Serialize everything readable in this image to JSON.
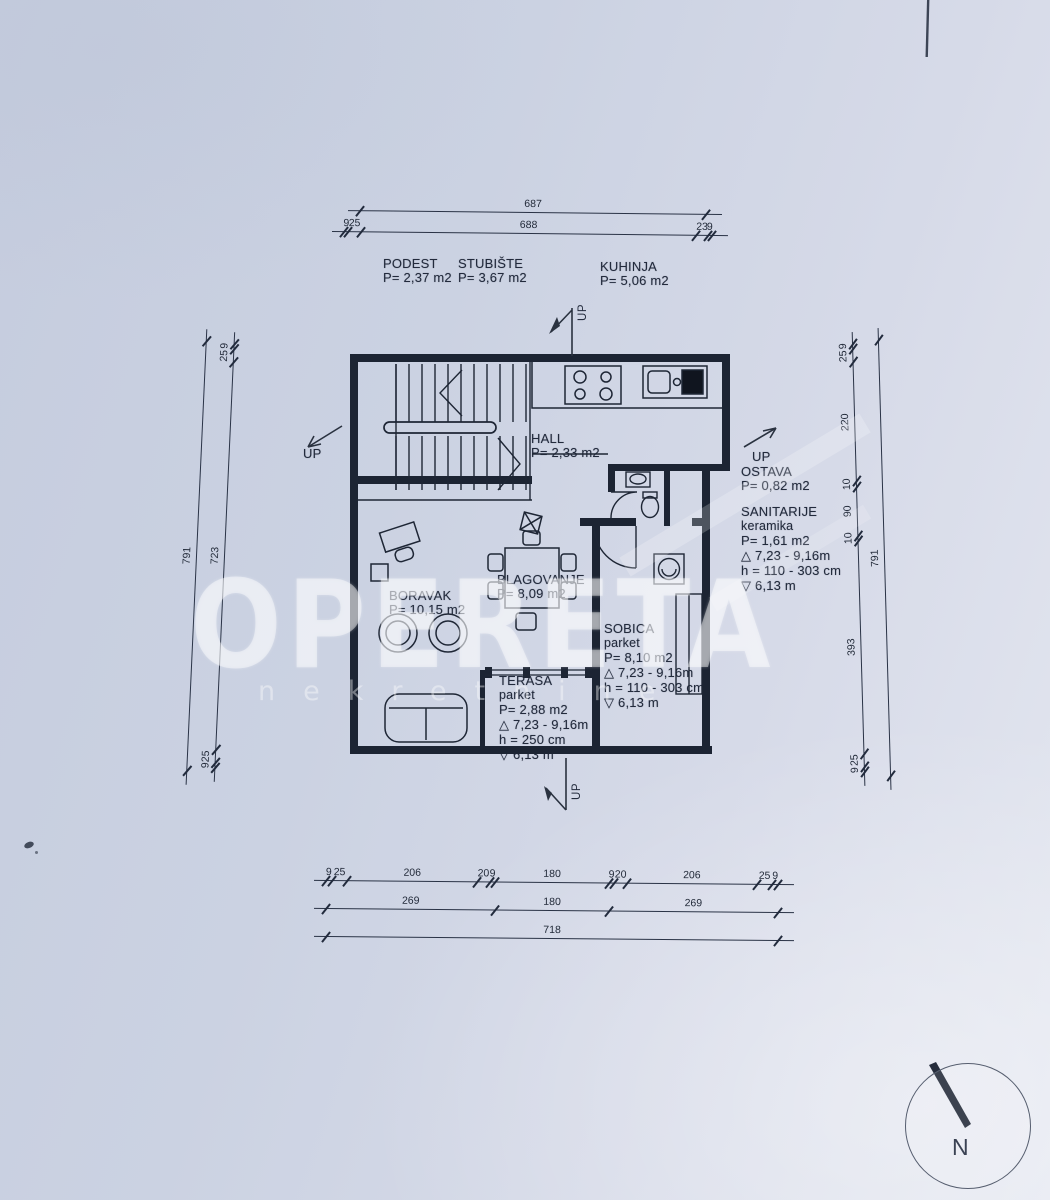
{
  "watermark": {
    "brand": "OPERETA",
    "sub": "nekretnine"
  },
  "compass": {
    "label": "N"
  },
  "labels": {
    "up": "UP"
  },
  "rooms": {
    "podest": {
      "name": "PODEST",
      "area": "P= 2,37 m2"
    },
    "stubiste": {
      "name": "STUBIŠTE",
      "area": "P= 3,67 m2"
    },
    "kuhinja": {
      "name": "KUHINJA",
      "area": "P= 5,06 m2"
    },
    "hall": {
      "name": "HALL",
      "area": "P= 2,33 m2"
    },
    "ostava": {
      "name": "OSTAVA",
      "area": "P= 0,82 m2"
    },
    "sanitarije": {
      "name": "SANITARIJE",
      "floor": "keramika",
      "area": "P= 1,61 m2",
      "elevation": "△ 7,23 - 9,16m",
      "height": "h = 110 - 303 cm",
      "level": "▽ 6,13 m"
    },
    "boravak": {
      "name": "BORAVAK",
      "area": "P= 10,15 m2"
    },
    "blagovanje": {
      "name": "BLAGOVANJE",
      "area": "P= 8,09 m2"
    },
    "sobica": {
      "name": "SOBICA",
      "floor": "parket",
      "area": "P= 8,10 m2",
      "elevation": "△ 7,23 - 9,16m",
      "height": "h = 110 - 303 cm",
      "level": "▽ 6,13 m"
    },
    "terasa": {
      "name": "TERASA",
      "floor": "parket",
      "area": "P= 2,88 m2",
      "elevation": "△ 7,23 - 9,16m",
      "height": "h = 250 cm",
      "level": "▽ 6,13 m"
    }
  },
  "dimensions": {
    "top_total": [
      "687"
    ],
    "top_chain": [
      "9",
      "25",
      "688",
      "23",
      "9"
    ],
    "left_total": [
      "791"
    ],
    "left_chain": [
      "9",
      "25",
      "723",
      "25",
      "9"
    ],
    "right_total": [
      "791"
    ],
    "right_chain": [
      "9",
      "25",
      "220",
      "10",
      "90",
      "10",
      "393",
      "25",
      "9"
    ],
    "bottom_chain": [
      "9",
      "25",
      "206",
      "20",
      "9",
      "180",
      "9",
      "20",
      "206",
      "25",
      "9"
    ],
    "bottom_mid": [
      "269",
      "180",
      "269"
    ],
    "bottom_total": [
      "718"
    ]
  }
}
